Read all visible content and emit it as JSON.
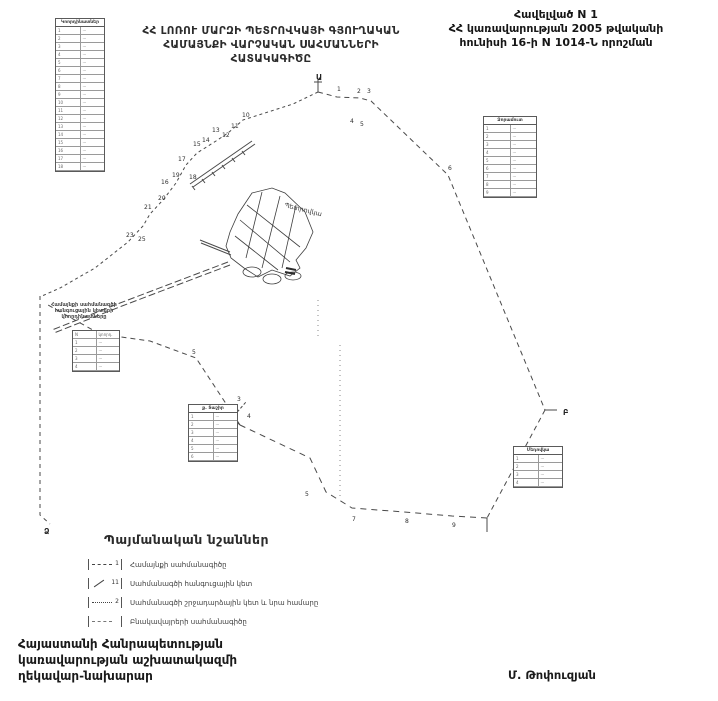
{
  "appendix": {
    "line1": "Հավելված N 1",
    "line2": "ՀՀ կառավարության 2005 թվականի",
    "line3": "հունիսի 16-ի N 1014-Ն որոշման"
  },
  "title": {
    "line1": "ՀՀ ԼՈՌՈՒ ՄԱՐԶԻ ՊԵՏՐՈՎԿԱՅԻ ԳՅՈՒՂԱԿԱՆ",
    "line2": "ՀԱՄԱՅՆՔԻ ՎԱՐՉԱԿԱՆ ՍԱՀՄԱՆՆԵՐԻ",
    "line3": "ՀԱՏԱԿԱԳԻԾԸ"
  },
  "map": {
    "settlement_label": "Պետրովկա",
    "junction_letters": [
      {
        "ch": "Ա",
        "x": 316,
        "y": 80
      },
      {
        "ch": "Բ",
        "x": 563,
        "y": 415
      },
      {
        "ch": "Ձ",
        "x": 44,
        "y": 534
      }
    ],
    "point_numbers": [
      {
        "n": "1",
        "x": 337,
        "y": 91
      },
      {
        "n": "2",
        "x": 357,
        "y": 93
      },
      {
        "n": "3",
        "x": 367,
        "y": 93
      },
      {
        "n": "4",
        "x": 350,
        "y": 123
      },
      {
        "n": "5",
        "x": 360,
        "y": 126
      },
      {
        "n": "6",
        "x": 448,
        "y": 170
      },
      {
        "n": "7",
        "x": 352,
        "y": 521
      },
      {
        "n": "8",
        "x": 405,
        "y": 523
      },
      {
        "n": "9",
        "x": 452,
        "y": 527
      },
      {
        "n": "5",
        "x": 305,
        "y": 496
      },
      {
        "n": "10",
        "x": 242,
        "y": 117
      },
      {
        "n": "11",
        "x": 231,
        "y": 128
      },
      {
        "n": "12",
        "x": 222,
        "y": 137
      },
      {
        "n": "13",
        "x": 212,
        "y": 132
      },
      {
        "n": "14",
        "x": 202,
        "y": 142
      },
      {
        "n": "15",
        "x": 193,
        "y": 146
      },
      {
        "n": "17",
        "x": 178,
        "y": 161
      },
      {
        "n": "18",
        "x": 189,
        "y": 179
      },
      {
        "n": "19",
        "x": 172,
        "y": 177
      },
      {
        "n": "16",
        "x": 161,
        "y": 184
      },
      {
        "n": "20",
        "x": 158,
        "y": 200
      },
      {
        "n": "21",
        "x": 144,
        "y": 209
      },
      {
        "n": "23",
        "x": 126,
        "y": 237
      },
      {
        "n": "25",
        "x": 138,
        "y": 241
      },
      {
        "n": "2",
        "x": 230,
        "y": 428
      },
      {
        "n": "3",
        "x": 237,
        "y": 401
      },
      {
        "n": "4",
        "x": 247,
        "y": 418
      },
      {
        "n": "5",
        "x": 192,
        "y": 354
      }
    ]
  },
  "tables": {
    "coords_left": {
      "title": "Կոորդինատներ",
      "rows": [
        [
          "1",
          "···"
        ],
        [
          "2",
          "···"
        ],
        [
          "3",
          "···"
        ],
        [
          "4",
          "···"
        ],
        [
          "5",
          "···"
        ],
        [
          "6",
          "···"
        ],
        [
          "7",
          "···"
        ],
        [
          "8",
          "···"
        ],
        [
          "9",
          "···"
        ],
        [
          "10",
          "···"
        ],
        [
          "11",
          "···"
        ],
        [
          "12",
          "···"
        ],
        [
          "13",
          "···"
        ],
        [
          "14",
          "···"
        ],
        [
          "15",
          "···"
        ],
        [
          "16",
          "···"
        ],
        [
          "17",
          "···"
        ],
        [
          "18",
          "···"
        ]
      ]
    },
    "coords_right": {
      "title": "Ձորամուտ",
      "rows": [
        [
          "1",
          "···"
        ],
        [
          "2",
          "···"
        ],
        [
          "3",
          "···"
        ],
        [
          "4",
          "···"
        ],
        [
          "5",
          "···"
        ],
        [
          "6",
          "···"
        ],
        [
          "7",
          "···"
        ],
        [
          "8",
          "···"
        ],
        [
          "9",
          "···"
        ]
      ]
    },
    "disputed": {
      "caption1": "Համայնքի սահմանագծի",
      "caption2": "հանգուցային կետերի",
      "caption3": "կոորդինատները",
      "rows": [
        [
          "N",
          "կոորդ."
        ],
        [
          "1",
          "···"
        ],
        [
          "2",
          "···"
        ],
        [
          "3",
          "···"
        ],
        [
          "4",
          "···"
        ]
      ]
    },
    "tashir": {
      "title": "ք. Տաշիր",
      "rows": [
        [
          "1",
          "···"
        ],
        [
          "2",
          "···"
        ],
        [
          "3",
          "···"
        ],
        [
          "4",
          "···"
        ],
        [
          "5",
          "···"
        ],
        [
          "6",
          "···"
        ]
      ]
    },
    "medovka": {
      "title": "Մեդովկա",
      "rows": [
        [
          "1",
          "···"
        ],
        [
          "2",
          "···"
        ],
        [
          "3",
          "···"
        ],
        [
          "4",
          "···"
        ]
      ]
    }
  },
  "legend": {
    "title": "Պայմանական նշաններ",
    "items": [
      {
        "num": "1",
        "label": "Համայնքի սահմանագիծը"
      },
      {
        "num": "11",
        "label": "Սահմանագծի հանգուցային կետ"
      },
      {
        "num": "2",
        "label": "Սահմանագծի շրջադարձային կետ և նրա համարը"
      },
      {
        "num": "",
        "label": "Բնակավայրերի սահմանագիծը"
      }
    ]
  },
  "footer": {
    "line1": "Հայաստանի Հանրապետության",
    "line2": "կառավարության աշխատակազմի",
    "line3": "ղեկավար-նախարար",
    "signature": "Մ. Թոփուզյան"
  }
}
